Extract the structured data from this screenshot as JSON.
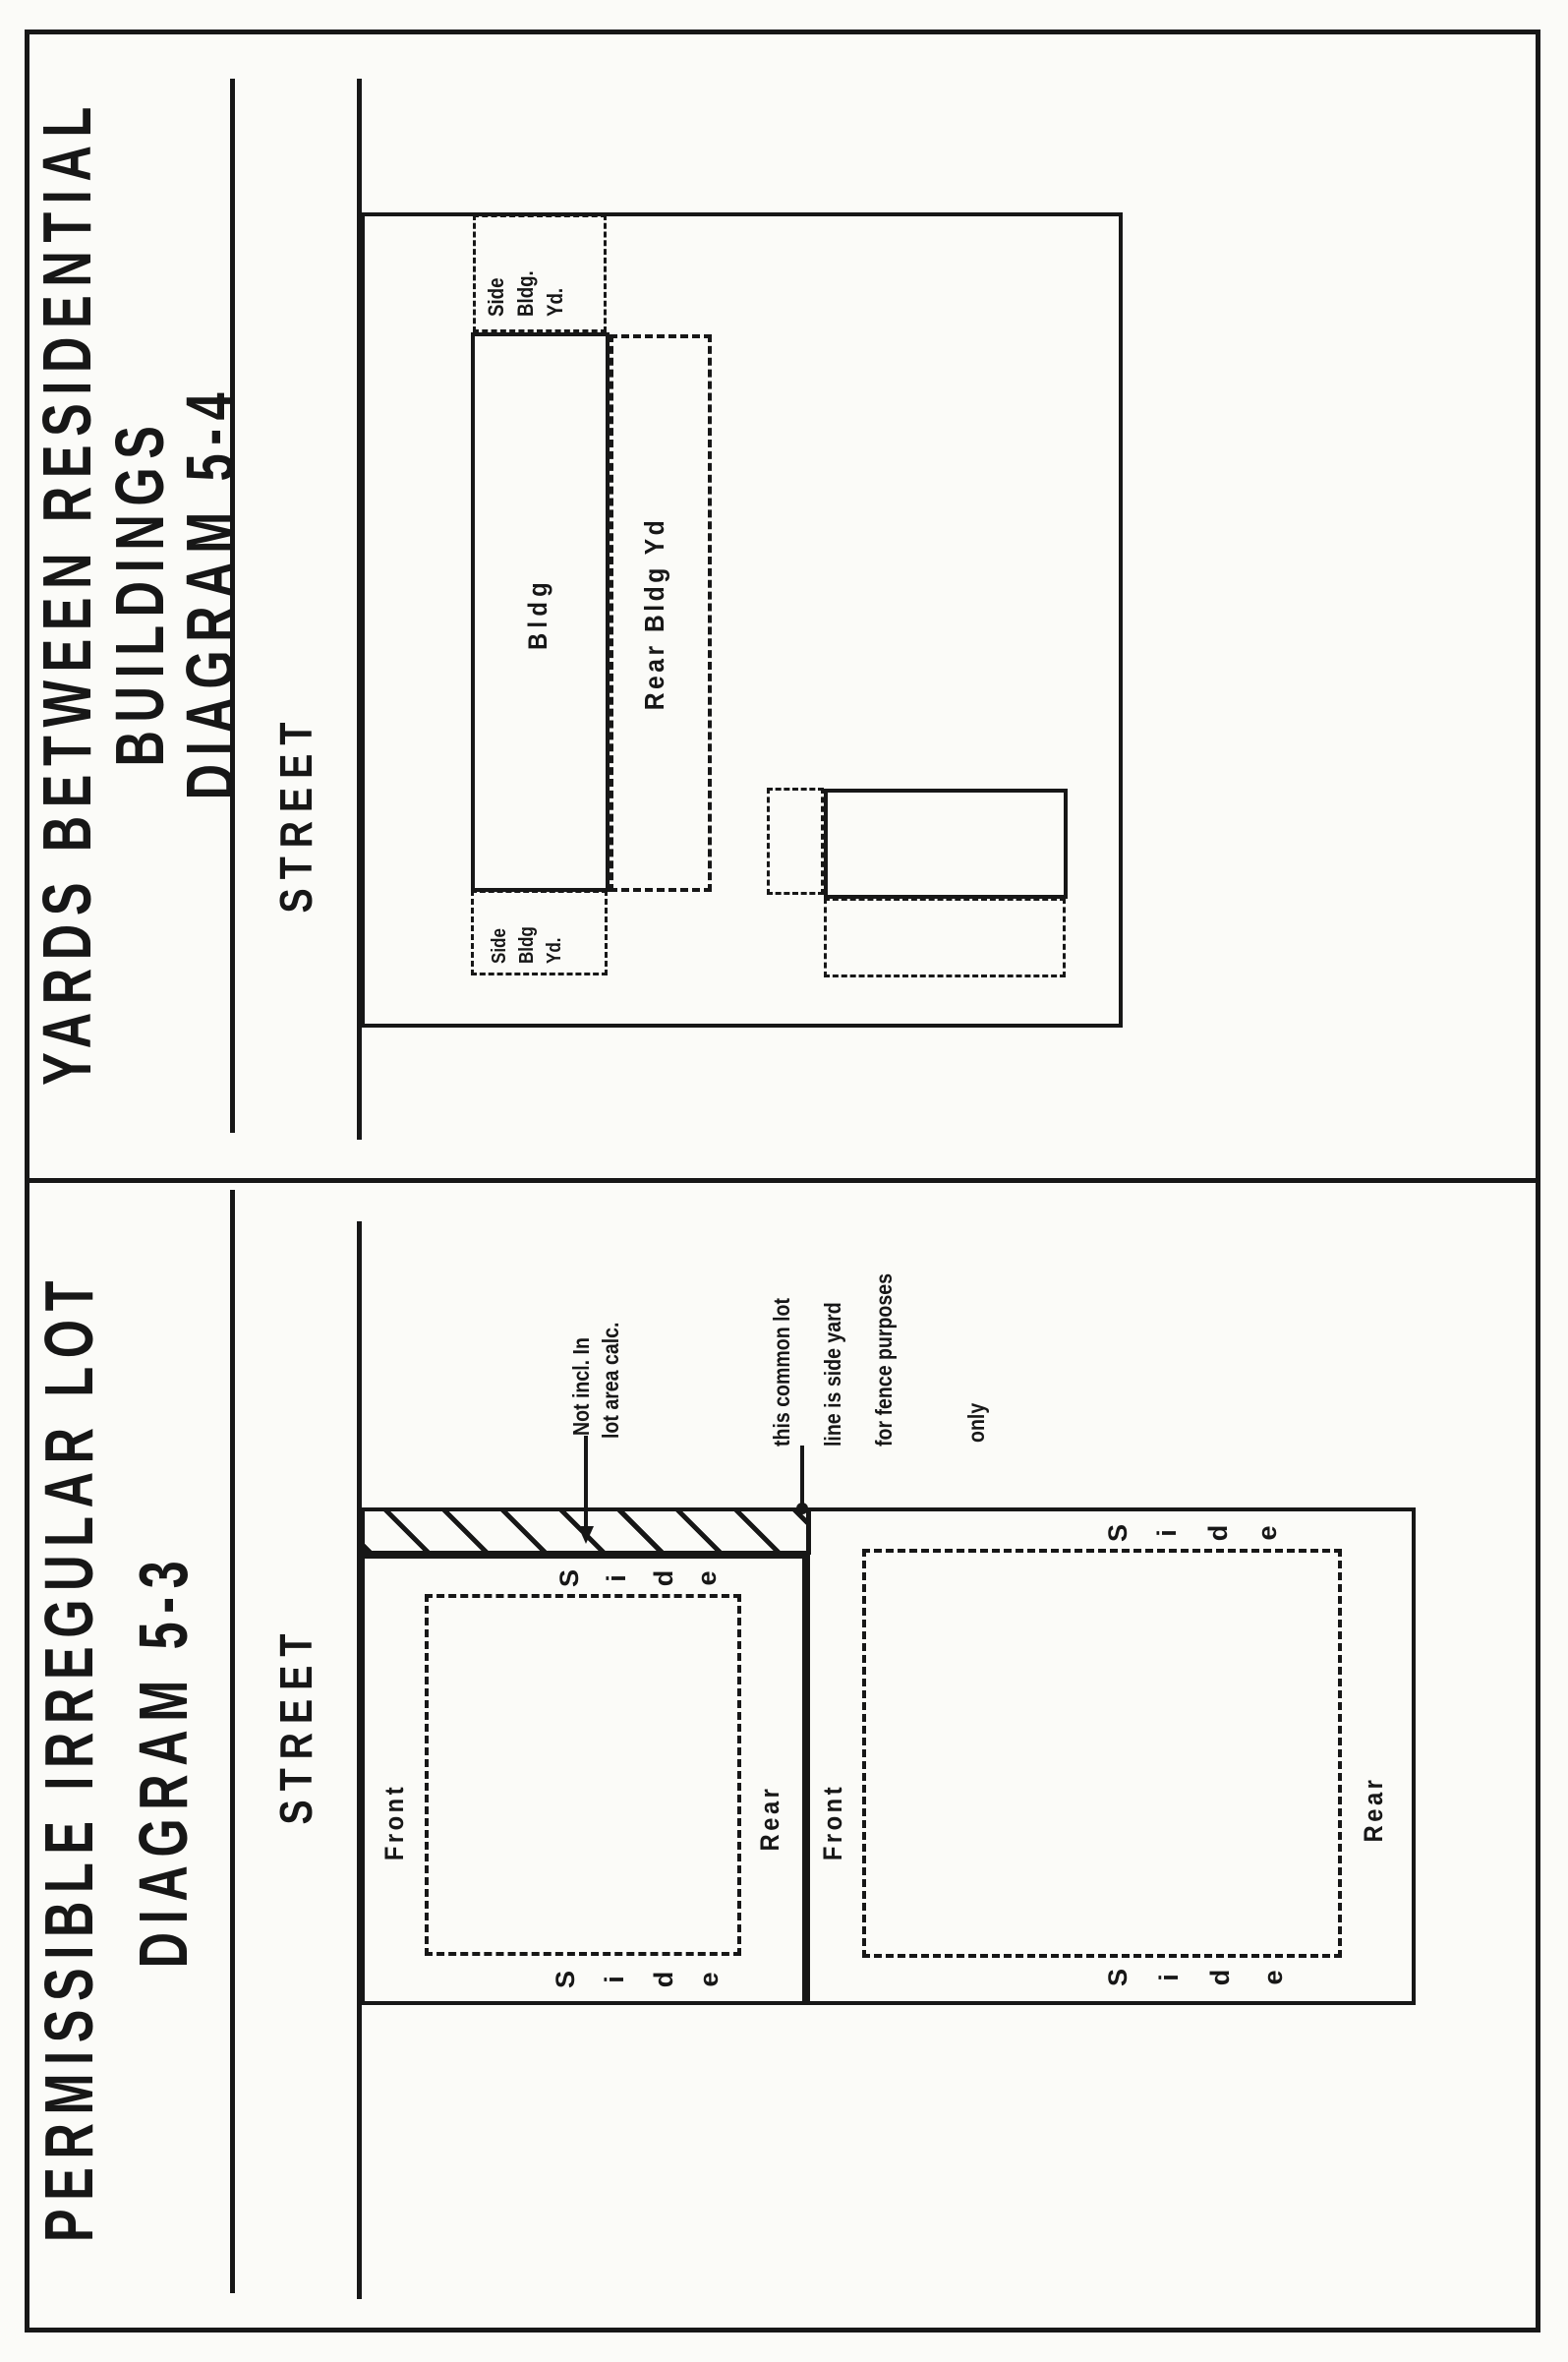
{
  "colors": {
    "ink": "#171717",
    "paper": "#fbfbf8"
  },
  "p53": {
    "title_line1": "PERMISSIBLE IRREGULAR LOT",
    "title_line2": "DIAGRAM 5-3",
    "street_label": "STREET",
    "lot1": {
      "front_label": "Front",
      "rear_label": "Rear",
      "side_left_letters": [
        "S",
        "i",
        "d",
        "e"
      ],
      "side_right_letters": [
        "S",
        "i",
        "d",
        "e"
      ]
    },
    "lot2": {
      "front_label": "Front",
      "rear_label": "Rear",
      "side_left_letters": [
        "S",
        "i",
        "d",
        "e"
      ],
      "side_right_letters": [
        "S",
        "i",
        "d",
        "e"
      ]
    },
    "hatch_note": {
      "line1": "Not incl. In",
      "line2": "lot area calc."
    },
    "common_note": {
      "line1": "this common lot",
      "line2": "line is side yard",
      "line3": "for fence purposes",
      "line4": "only"
    }
  },
  "p54": {
    "title_line1": "YARDS BETWEEN RESIDENTIAL",
    "title_line2": "BUILDINGS",
    "title_line3": "DIAGRAM 5-4",
    "street_label": "STREET",
    "bldg_label": "Bldg",
    "rear_yard_label": "Rear Bldg Yd",
    "side_yard_right": {
      "line1": "Side",
      "line2": "Bldg.",
      "line3": "Yd."
    },
    "side_yard_left": {
      "line1": "Side",
      "line2": "Bldg",
      "line3": "Yd."
    }
  }
}
